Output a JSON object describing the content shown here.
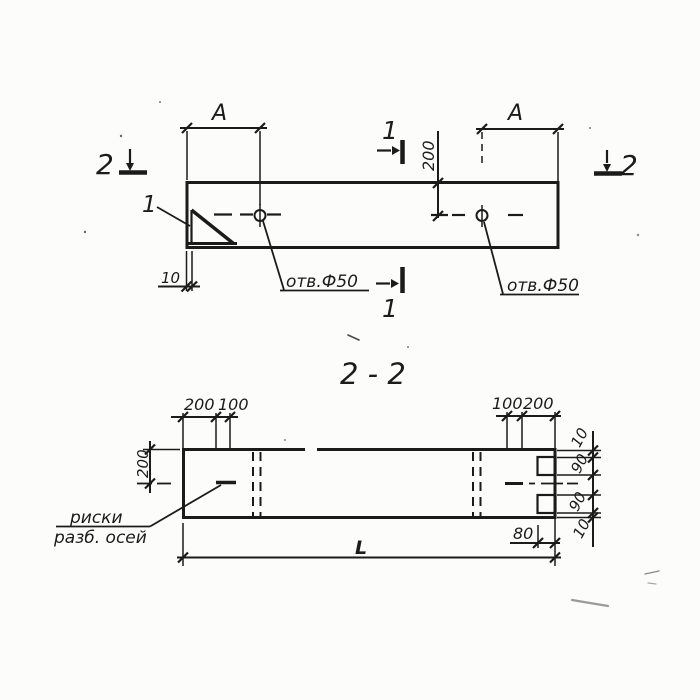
{
  "plan": {
    "cut_left": "2",
    "cut_right": "2",
    "cut_top": "1",
    "cut_bottom": "1",
    "detail_ref": "1",
    "dim_a_left": "A",
    "dim_a_right": "A",
    "dim_hole_from_edge": "200",
    "dim_chamfer": "10",
    "hole_note_1": "отв.Ф50",
    "hole_note_2": "отв.Ф50"
  },
  "section": {
    "title": "2 - 2",
    "dim_top_left_outer": "200",
    "dim_top_left_inner": "100",
    "dim_top_right_inner": "100",
    "dim_top_right_outer": "200",
    "dim_half_height": "200",
    "dim_right": [
      "10",
      "90",
      "90",
      "10"
    ],
    "dim_notch_depth": "80",
    "dim_length": "L",
    "note_axes_1": "риски",
    "note_axes_2": "разб. осей"
  },
  "colors": {
    "ink": "#1b1b1b",
    "paper": "#fcfcfb"
  }
}
